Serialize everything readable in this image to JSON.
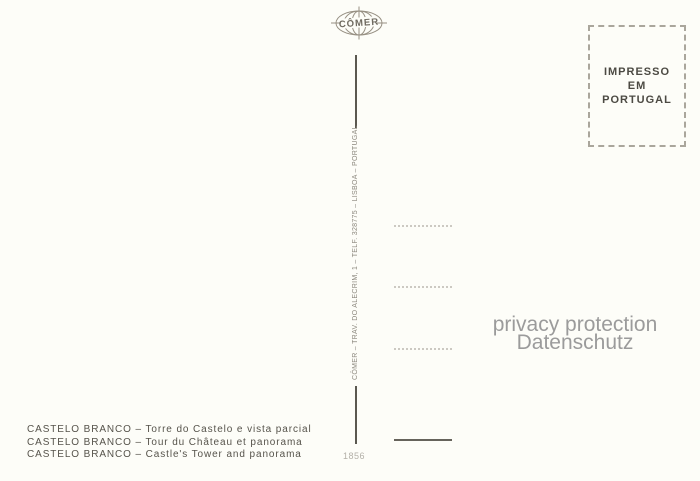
{
  "postcard": {
    "publisher_logo": "CÔMER",
    "stamp_box": {
      "lines": [
        "IMPRESSO",
        "EM",
        "PORTUGAL"
      ]
    },
    "spine_imprint": "CÔMER – TRAV. DO ALECRIM, 1 – TELF. 328775 – LISBOA – PORTUGAL",
    "serial_number": "1856",
    "captions": [
      "CASTELO BRANCO – Torre do Castelo e vista parcial",
      "CASTELO BRANCO – Tour du Château et panorama",
      "CASTELO BRANCO – Castle's Tower and panorama"
    ],
    "watermark": {
      "line1": "privacy protection",
      "line2": "Datenschutz"
    },
    "colors": {
      "background": "#fdfdf8",
      "ink": "#56534b",
      "stamp_text": "#4c4a43",
      "watermark": "#9b9b9b",
      "spine": "#5b5850"
    }
  }
}
